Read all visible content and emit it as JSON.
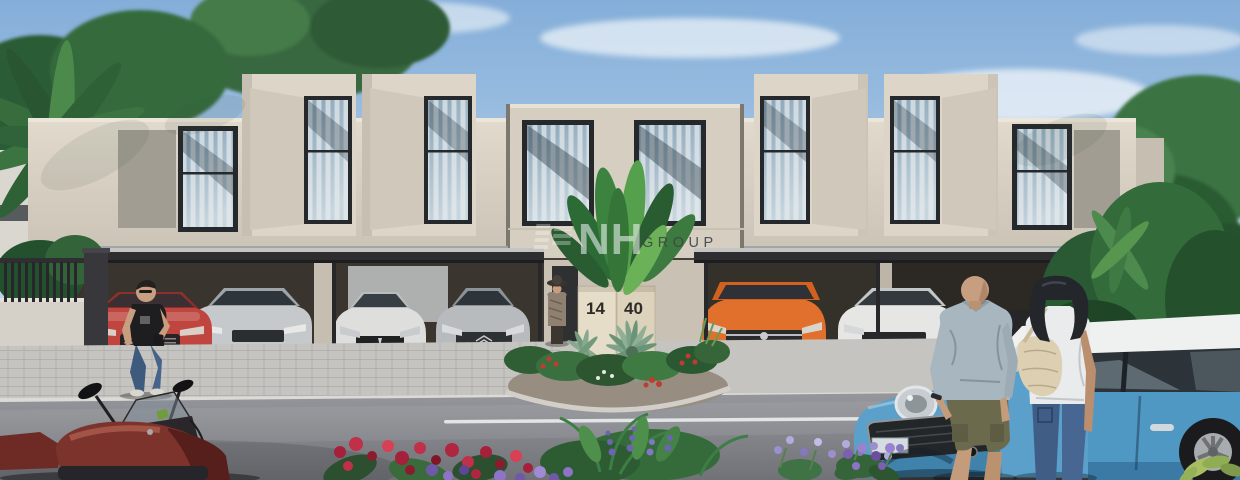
{
  "scene": {
    "title": "Modern townhouse community exterior render with carports, parked cars and pedestrians",
    "watermark": {
      "brand": "NH",
      "suffix": "GROUP"
    },
    "sign": {
      "left_number": "14",
      "right_number": "40"
    },
    "colors": {
      "sky_top": "#85aed8",
      "sky_horizon": "#dfe9f2",
      "facade_cream": "#dad2c5",
      "facade_panel_gray": "#a29d93",
      "fascia_gray": "#93989c",
      "window_frame": "#26292b",
      "glass_blue": "#9db4c4",
      "curtain_white": "#e9edef",
      "carport_dark": "#2e2e30",
      "bay_shadow": "#39352e",
      "sidewalk_gray": "#c6c4c0",
      "road_gray": "#85878c",
      "lane_line_white": "#e9ebee",
      "foliage_dark": "#24512d",
      "foliage_mid": "#3a7440",
      "foliage_light": "#5e9c52",
      "cycad_gray_green": "#7da289",
      "car_red": "#bf453e",
      "car_silver": "#c6c9cc",
      "car_silver_dark": "#b7bbbe",
      "car_white": "#dedfdd",
      "car_white_coupe": "#e6e7e5",
      "car_orange": "#e0702c",
      "mini_blue": "#5aa0ca",
      "mini_blue_side": "#5098c4",
      "mini_roof_white": "#eff1f1",
      "motorcycle_maroon": "#7b332c",
      "flower_red": "#b02540",
      "flower_purple": "#7a63b5",
      "flower_lavender": "#9d93cf",
      "sign_panel_left": "#e6ddc8",
      "sign_panel_right": "#ddd2bb",
      "sign_number_dark": "#2e2b27",
      "skin_tone": "#c79e7f",
      "jeans_blue": "#3f5d85",
      "shirt_gray_blue": "#a7b6bf",
      "shorts_olive": "#6b6a4d",
      "tshirt_black": "#1e1e20",
      "top_white": "#e9ebec",
      "bag_beige": "#ddd0b2"
    }
  }
}
